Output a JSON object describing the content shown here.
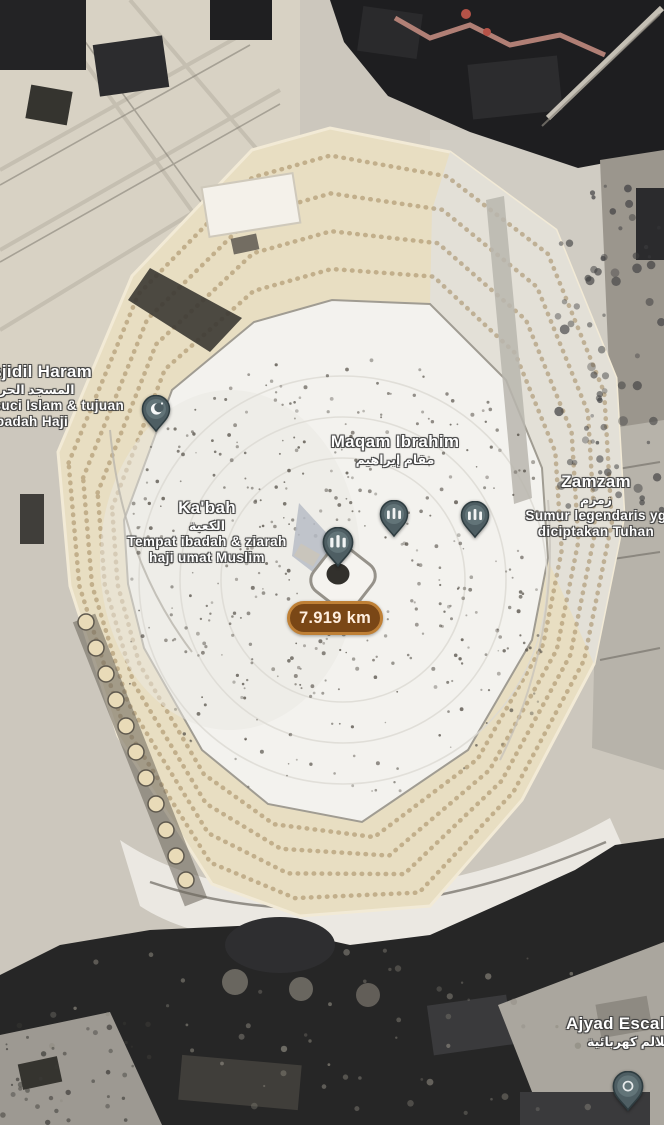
{
  "colors": {
    "badge_bg": "#7a4716",
    "badge_border": "#bf8036",
    "pin_fill": "#4e5e63",
    "pin_edge": "#2e3c40",
    "label_text": "#ffffff"
  },
  "measurement": {
    "distance": "7.919 km"
  },
  "labels": {
    "masjidil_haram": {
      "name": "Masjidil Haram",
      "arabic": "المسجد الحرام",
      "desc1": "Situs tersuci Islam & tujuan",
      "desc2": "ibadah Haji"
    },
    "maqam_ibrahim": {
      "name": "Maqam Ibrahim",
      "arabic": "مقام إبراهيم"
    },
    "kabah": {
      "name": "Ka'bah",
      "arabic": "الكعبة",
      "desc1": "Tempat ibadah & ziarah",
      "desc2": "haji umat Muslim"
    },
    "zamzam": {
      "name": "Zamzam",
      "arabic": "زمزم",
      "desc1": "Sumur legendaris yg",
      "desc2": "diciptakan Tuhan"
    },
    "ajyad_escalator": {
      "name": "Ajyad Escalator",
      "arabic": "سلالم كهربائية"
    }
  },
  "markers": [
    {
      "name": "masjidil-haram-pin",
      "icon": "crescent-pin"
    },
    {
      "name": "kabah-pin",
      "icon": "mosque-pin"
    },
    {
      "name": "maqam-ibrahim-pin",
      "icon": "mosque-pin"
    },
    {
      "name": "zamzam-pin",
      "icon": "mosque-pin"
    },
    {
      "name": "ajyad-escalator-pin",
      "icon": "dot-pin"
    }
  ]
}
